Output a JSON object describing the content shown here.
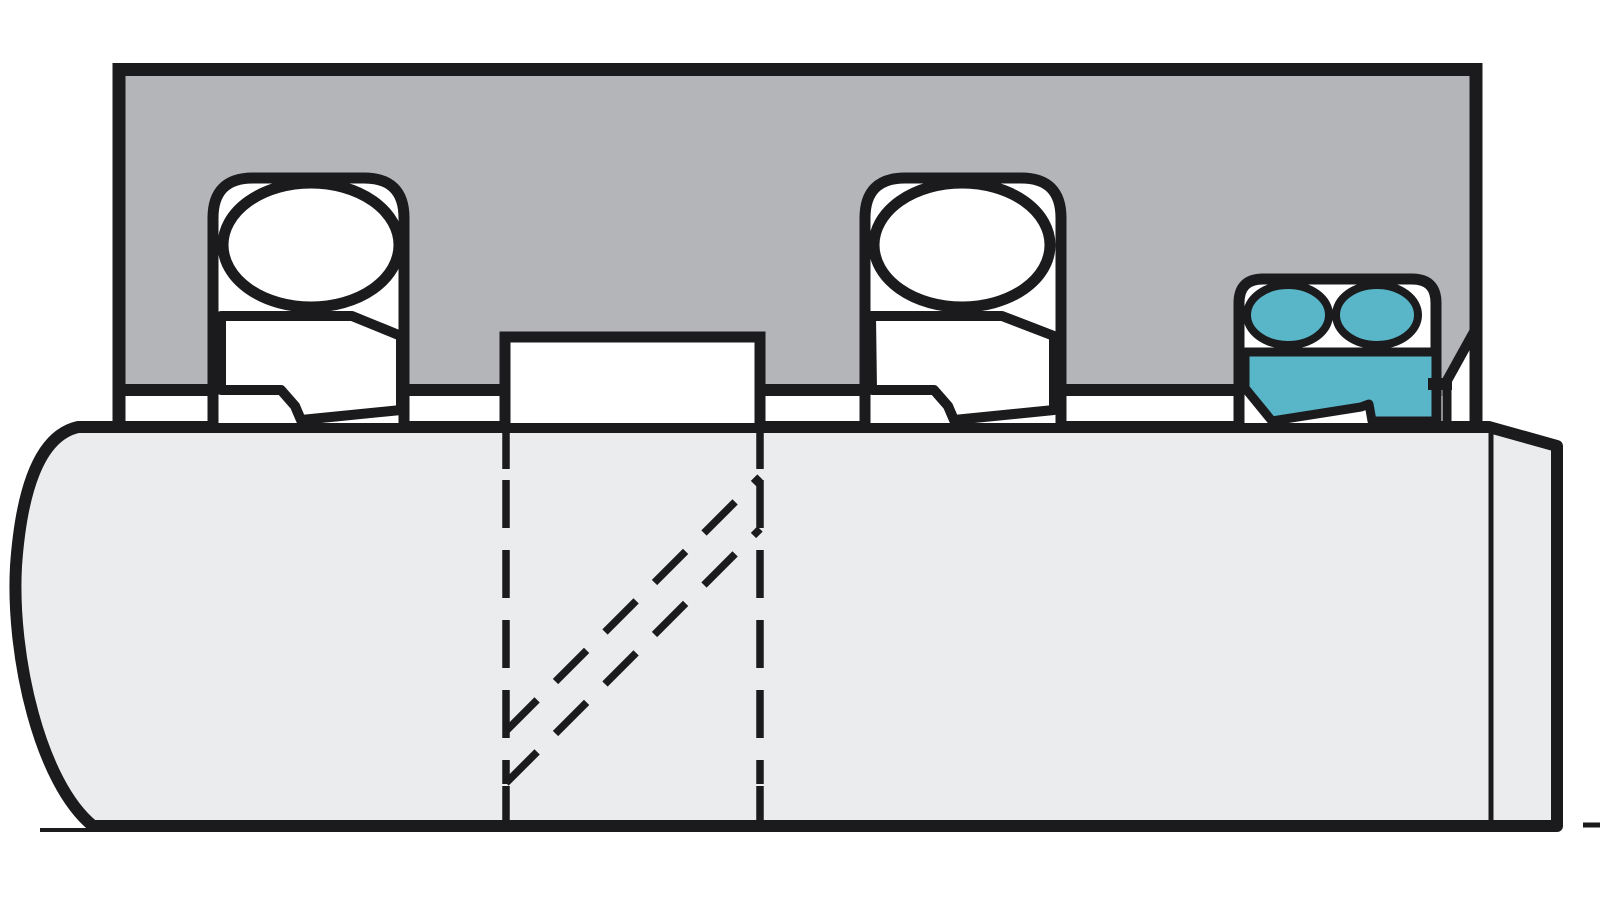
{
  "canvas": {
    "width": 1600,
    "height": 900
  },
  "diagram": {
    "description": "Cross-section of a cylinder gland with two O-ring energized step seals, a center spacer collar, and a highlighted double-acting scraper seal with twin O-rings installed over a rod",
    "parts": {
      "housing": "gland-housing",
      "rod": "rod-shaft",
      "groove_left": "seal-groove-left",
      "groove_center": "seal-groove-center",
      "groove_right": "scraper-groove",
      "seal_left": "step-seal-left",
      "seal_center": "step-seal-center",
      "oring_left": "o-ring-left",
      "oring_center": "o-ring-center",
      "scraper": "double-scraper-seal-highlighted",
      "scraper_oring_1": "scraper-o-ring-left",
      "scraper_oring_2": "scraper-o-ring-right",
      "hidden_lines": "hidden-section-lines",
      "axis_marks": "baseline-marks"
    },
    "colors": {
      "background": "#ffffff",
      "outline": "#1b1b1d",
      "housing_fill": "#b4b5b8",
      "rod_fill": "#ebecee",
      "seal_white": "#ffffff",
      "highlight_fill": "#58b6c8"
    }
  }
}
